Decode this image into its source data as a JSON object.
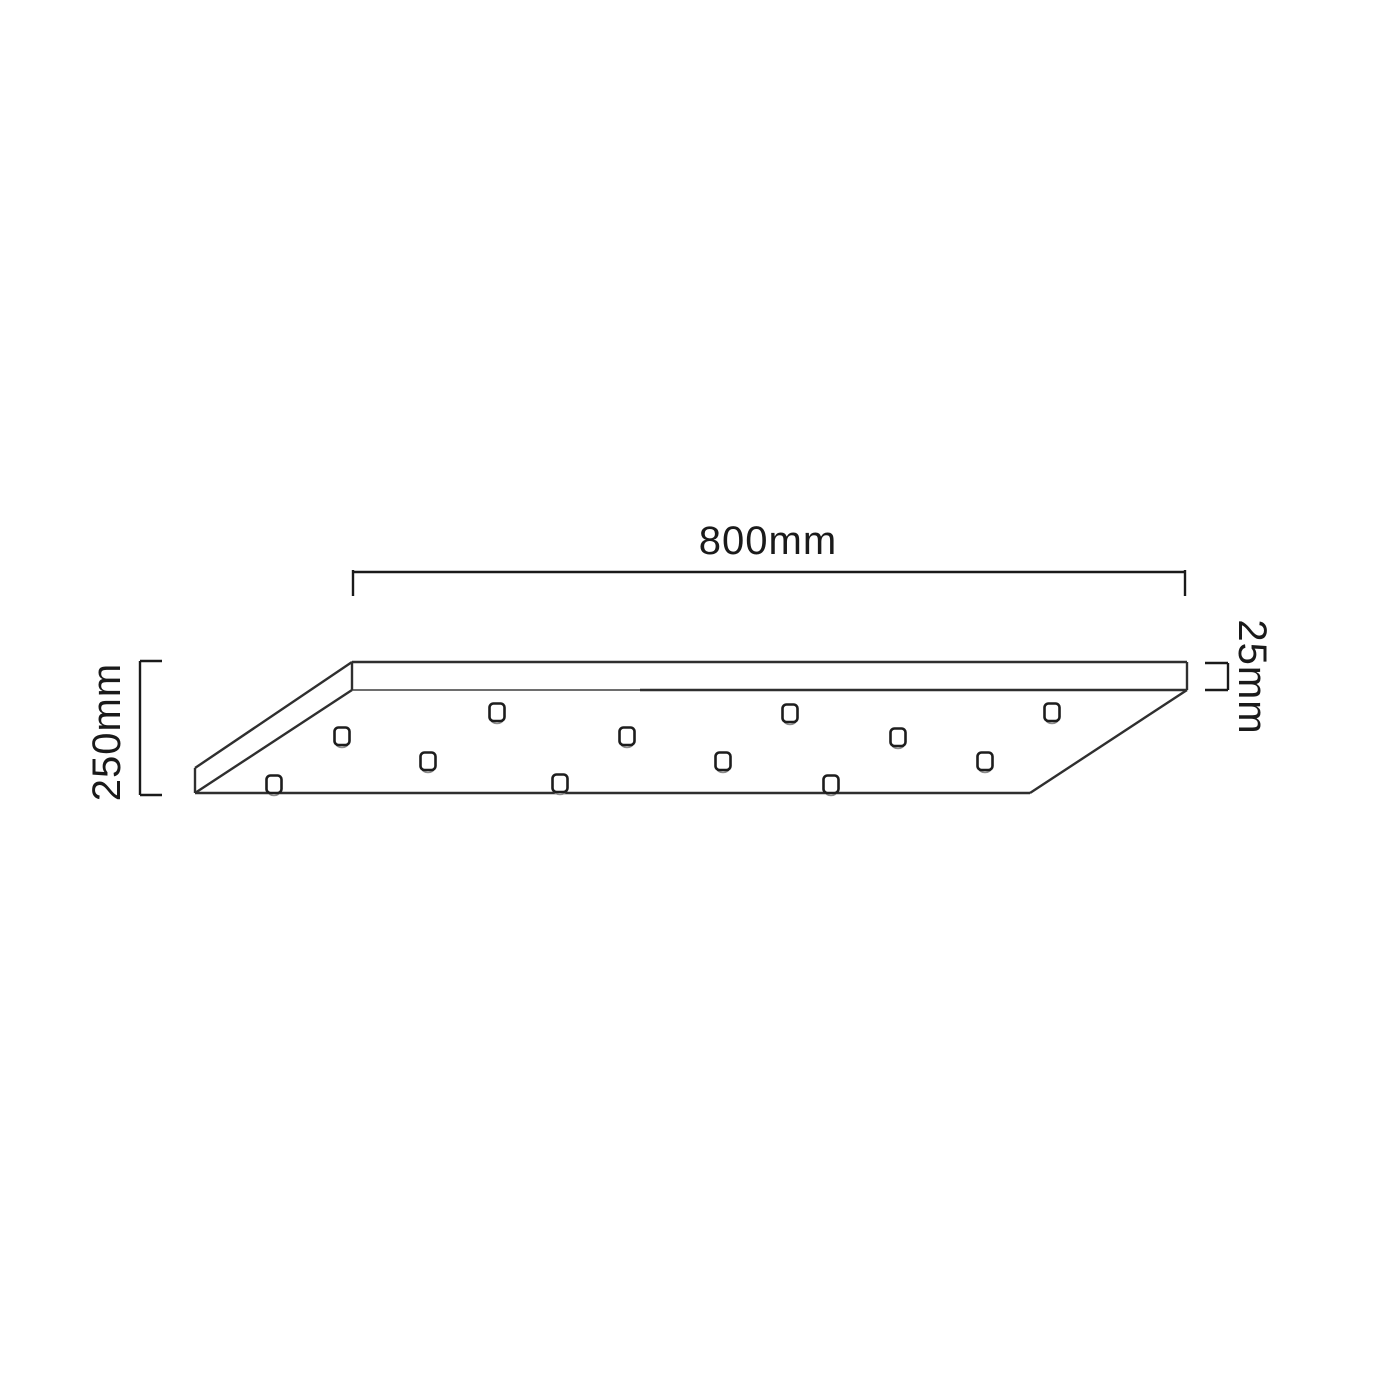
{
  "diagram": {
    "type": "technical-line-drawing",
    "subject": "Rectangular ceiling canopy plate, perspective view, with twelve cord suspension holes",
    "dimensions": {
      "width_label": "800mm",
      "depth_label": "250mm",
      "thickness_label": "25mm"
    },
    "colors": {
      "background": "#ffffff",
      "outline": "#2f2f2f",
      "dimension_line": "#1a1a1a",
      "hole_rim_shade": "#8a8a8a"
    },
    "holes": {
      "count": 12,
      "positions": [
        [
          497,
          714
        ],
        [
          790,
          715
        ],
        [
          1052,
          714
        ],
        [
          342,
          738
        ],
        [
          627,
          738
        ],
        [
          898,
          739
        ],
        [
          428,
          763
        ],
        [
          723,
          763
        ],
        [
          985,
          763
        ],
        [
          274,
          786
        ],
        [
          560,
          785
        ],
        [
          831,
          786
        ]
      ]
    }
  }
}
